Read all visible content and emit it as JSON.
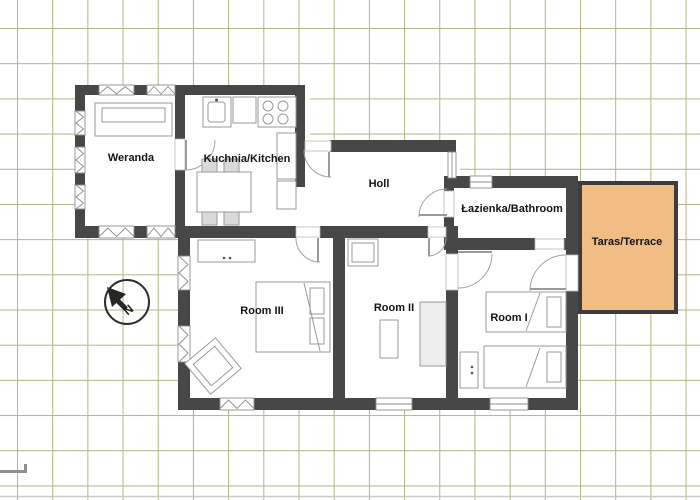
{
  "plan": {
    "rooms": [
      {
        "id": "weranda",
        "label": "Weranda"
      },
      {
        "id": "kitchen",
        "label": "Kuchnia/Kitchen"
      },
      {
        "id": "holl",
        "label": "Holl"
      },
      {
        "id": "bathroom",
        "label": "Łazienka/Bathroom"
      },
      {
        "id": "terrace",
        "label": "Taras/Terrace"
      },
      {
        "id": "room-3",
        "label": "Room III"
      },
      {
        "id": "room-2",
        "label": "Room II"
      },
      {
        "id": "room-1",
        "label": "Room I"
      }
    ],
    "compass": {
      "label": "N"
    },
    "colors": {
      "wall": "#474747",
      "terrace_fill": "#f2bd85",
      "terrace_border": "#3c3c3c",
      "grid_line": "#b3b584",
      "background": "#ffffff",
      "furniture_outline": "#9a9a9a"
    }
  }
}
